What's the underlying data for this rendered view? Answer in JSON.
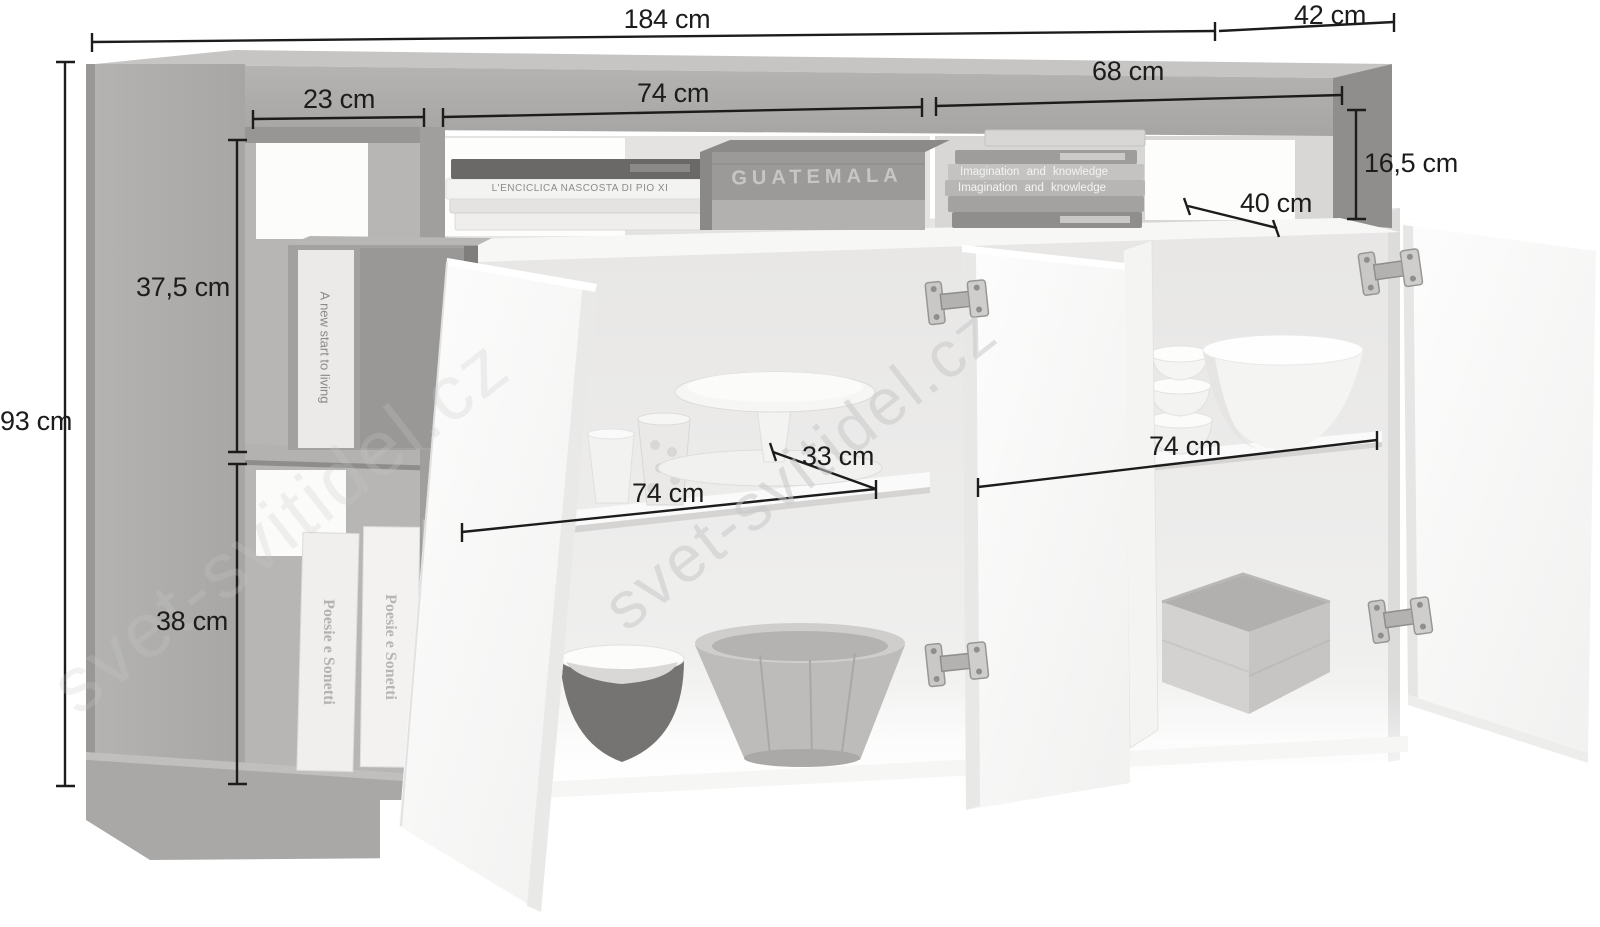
{
  "page": {
    "background": "#ffffff"
  },
  "watermark": {
    "text": "svet-svitidel.cz",
    "color": "#c9c9c9"
  },
  "colors": {
    "dimension_ink": "#1c1c1c",
    "frame_gray": "#b0afad",
    "frame_gray_dark": "#8f8e8c",
    "frame_gray_top": "#c6c5c3",
    "door_white": "#fbfbfa",
    "interior_white": "#ececeb"
  },
  "dimensions": {
    "total_width": "184 cm",
    "depth": "42 cm",
    "height": "93 cm",
    "left_open_shelf_width": "23 cm",
    "top_middle_niche_width": "74 cm",
    "top_right_niche_width": "68 cm",
    "top_niche_height": "16,5 cm",
    "top_niche_depth": "40 cm",
    "upper_open_shelf_height": "37,5 cm",
    "lower_open_shelf_height": "38 cm",
    "left_compartment_width": "74 cm",
    "shelf_depth": "33 cm",
    "right_compartment_width": "74 cm"
  },
  "decor": {
    "standing_book_spine": "A new start to living",
    "poetry_book_left": "Poesie e Sonetti",
    "poetry_book_right": "Poesie e Sonetti",
    "crate_stencil": "GUATEMALA",
    "stacked_book_spine": "L'ENCICLICA NASCOSTA DI PIO XI",
    "photo_book_spine_top": "Imagination and knowledge",
    "photo_book_spine_bottom": "Imagination and knowledge"
  }
}
